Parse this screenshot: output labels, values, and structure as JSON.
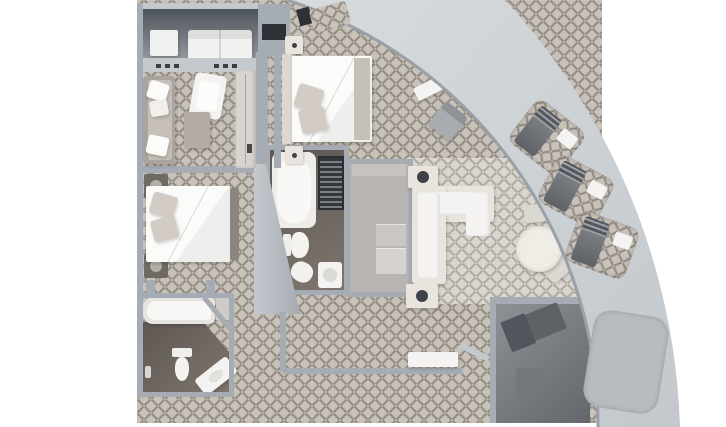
{
  "meta": {
    "title": "Curved suite floor plan",
    "view": "top-down 3D architectural render",
    "visible_text": "none (image contains no readable text, labels or numbers)"
  },
  "palette": {
    "bg": "#ffffff",
    "band-a": "#d7dbde",
    "band-b": "#c3c8cd",
    "band-edge": "#9aa0a7",
    "band-niche": "#b7bcc1",
    "wall": "#a6acb3",
    "wall-light": "#c4c9ce",
    "carpet-base": "#c8c2ba",
    "carpet-line": "rgba(118,110,101,0.5)",
    "carpet2-base": "#dad6d0",
    "carpet2-line": "rgba(146,140,131,0.45)",
    "floor-dark-a": "#4e545b",
    "floor-dark-b": "#94989d",
    "bath-floor-a": "#5f5853",
    "bath-floor-b": "#7d756d",
    "closet-floor": "#b8b4b1",
    "white": "#f4f3f1",
    "bright-white": "#fbfbfa",
    "cream": "#e9e5de",
    "pillow": "#d2ccc4",
    "headboard": "#dcd7d0",
    "taupe": "#b2aca5",
    "dark-furn": "#6d7176",
    "darker": "#3a3d42",
    "notch-dark": "#2e3136",
    "lamp": "#3f4347"
  },
  "rooms": [
    {
      "id": "top-balcony",
      "type": "balcony",
      "floor": "dark-decking",
      "furniture": [
        "double-sun-lounger",
        "side-table"
      ]
    },
    {
      "id": "sitting-room",
      "type": "bedroom-sitting",
      "floor": "patterned-carpet",
      "furniture": [
        "chaise-longue",
        "armchair",
        "side-table",
        "wardrobe"
      ]
    },
    {
      "id": "guest-bedroom",
      "type": "bedroom",
      "floor": "patterned-carpet",
      "furniture": [
        "double-bed",
        "nightstand-with-lamp",
        "nightstand-with-lamp",
        "foot-bench"
      ]
    },
    {
      "id": "guest-bathroom",
      "type": "bathroom",
      "floor": "dark-tile",
      "furniture": [
        "bathtub",
        "toilet",
        "vanity-sink",
        "wall-light"
      ]
    },
    {
      "id": "master-bedroom",
      "type": "bedroom",
      "floor": "patterned-carpet",
      "furniture": [
        "double-bed",
        "nightstand",
        "nightstand",
        "desk",
        "desk-chair"
      ]
    },
    {
      "id": "master-bathroom",
      "type": "bathroom",
      "floor": "dark-tile",
      "furniture": [
        "bathtub",
        "shower",
        "toilet",
        "bidet",
        "sink"
      ]
    },
    {
      "id": "walk-in-closet",
      "type": "closet",
      "floor": "plain",
      "furniture": [
        "counter",
        "shelves"
      ]
    },
    {
      "id": "living-room",
      "type": "living-dining",
      "floor": "light-patterned-carpet",
      "furniture": [
        "l-shaped-sofa",
        "end-table-with-lamp",
        "end-table-with-lamp",
        "round-dining-table",
        "dining-chair",
        "dining-chair"
      ]
    },
    {
      "id": "entry-hall",
      "type": "hallway",
      "floor": "patterned-carpet",
      "furniture": [
        "console-bench",
        "entry-door"
      ]
    },
    {
      "id": "private-balcony",
      "type": "balcony",
      "floor": "dark-decking",
      "furniture": [
        "sun-lounger",
        "side-table"
      ]
    }
  ],
  "curved_band": {
    "description": "light grey curved hull / promenade sweeping from top centre to bottom right",
    "lounger_niches": 3,
    "niche_contents": [
      "sun-lounger",
      "side-table"
    ],
    "open_niche": 1
  }
}
